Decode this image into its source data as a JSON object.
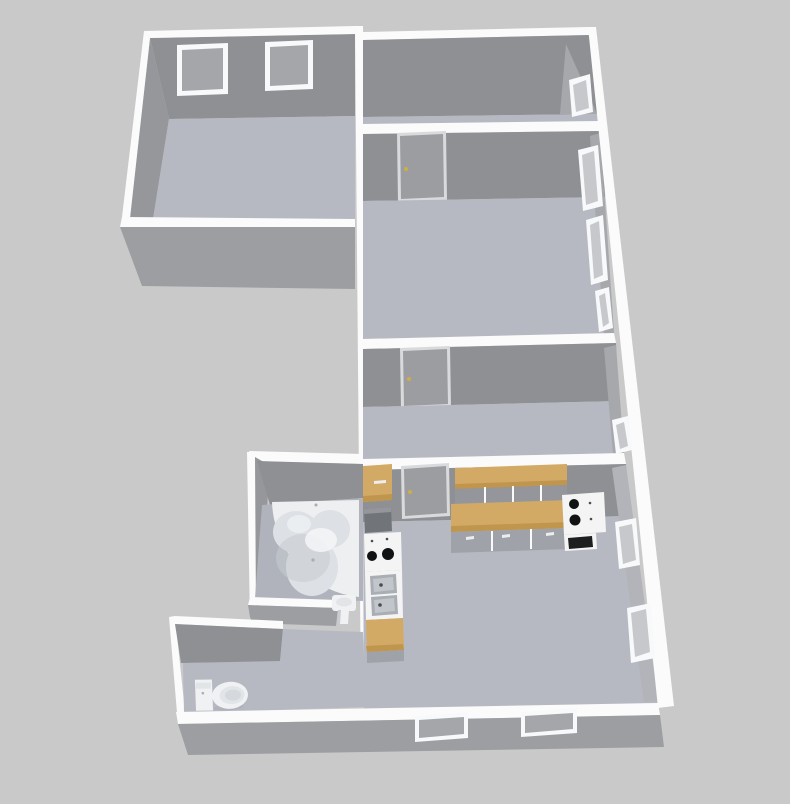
{
  "scene": {
    "view": "aerial-3d-dollhouse-floorplan",
    "rooms": [
      {
        "id": "room-top-left",
        "windows": 2
      },
      {
        "id": "room-right-top",
        "windows": 1
      },
      {
        "id": "room-right-middle",
        "windows": 3,
        "doors": 1
      },
      {
        "id": "room-right-lower",
        "windows": 1,
        "doors": 1
      },
      {
        "id": "kitchen",
        "windows": 4,
        "doors": 1,
        "fixtures": [
          "wall-cabinets",
          "countertop-run",
          "base-cabinets",
          "cooktop-right",
          "oven",
          "cooktop-left",
          "double-sink",
          "side-counter",
          "corner-cabinet"
        ]
      },
      {
        "id": "bathroom",
        "fixtures": [
          "corner-bathtub",
          "pedestal-sink"
        ]
      },
      {
        "id": "wc-hallway",
        "fixtures": [
          "toilet"
        ]
      }
    ]
  },
  "colors": {
    "background": "#c9c9c9",
    "wall_top": "#fbfbfb",
    "wall_face": "#8e9094",
    "wall_face_side": "#95979b",
    "wall_face_ext": "#9c9ea2",
    "wall_right_strip": "#a6a8ac",
    "wall_right_lit": "#b2b4b9",
    "floor": "#b6b9c2",
    "floor_bath": "#b0b3bc",
    "door_face": "#9b9da1",
    "door_frame": "#d8dadc",
    "door_knob": "#cfae45",
    "window_frame": "#f8f9fa",
    "window_pane": "#a4a6aa",
    "window_pane_light": "#c6c8cb",
    "wood": "#d3aa65",
    "wood_dark": "#c0964f",
    "cabinet_mid": "#94969b",
    "cabinet_front": "#9fa3a9",
    "cabinet_dark": "#717478",
    "appliance": "#f4f4f5",
    "burner": "#111214",
    "oven": "#1d1e20",
    "sink_basin": "#a9aeb4",
    "sink_basin_inner": "#c2c6cb",
    "fixture_white": "#f0f1f2",
    "fixture_inner": "#e2e5e8",
    "fixture_shade": "#c7cbd0",
    "tub_body": "#edeff1",
    "tub_basin": "#dde0e4",
    "tub_shade": "#c6cad0",
    "tub_highlight": "#f5f6f8",
    "mark": "#4a4c4f",
    "shadow": "#a9adb3",
    "handle_white": "#ededee"
  }
}
